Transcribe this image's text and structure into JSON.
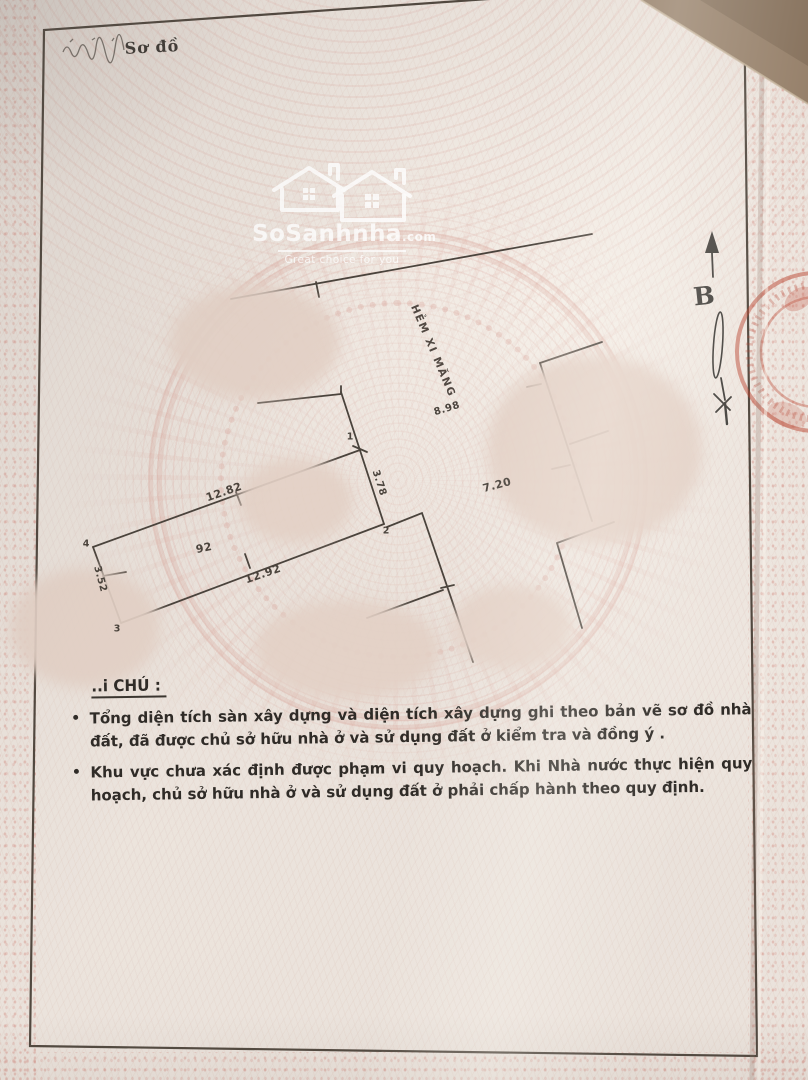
{
  "document": {
    "handwritten_label": "Sơ đồ",
    "note_heading": "..i CHÚ :",
    "notes": [
      {
        "bullet": "•",
        "text": "Tổng diện tích sàn xây dựng và diện tích xây dựng  ghi theo bản vẽ sơ đồ nhà đất, đã được chủ sở hữu nhà ở và sử dụng đất ở kiểm tra và đồng ý ."
      },
      {
        "bullet": "•",
        "text": "Khu vực chưa xác định được phạm vi quy hoạch. Khi Nhà nước thực hiện quy hoạch, chủ sở hữu nhà ở và sử dụng đất ở phải chấp hành theo quy định."
      }
    ]
  },
  "watermark": {
    "brand": "SoSanhnha",
    "suffix": ".com",
    "tagline": "Great choice for you"
  },
  "plan": {
    "street_name": "HẺM XI MĂNG",
    "north_symbol": "B",
    "parcel_number": "92",
    "measurements": {
      "road_frontage": "8.98",
      "north_edge": "12.82",
      "south_edge": "12.92",
      "west_edge": "3.52",
      "front_edge": "3.78",
      "right_edge": "7.20"
    },
    "points": [
      "1",
      "2",
      "3",
      "4"
    ]
  },
  "colors": {
    "paper": "#e9e1da",
    "ink": "#4a433c",
    "pattern_pink": "#d89e94",
    "stamp_red": "#ba4632",
    "note_ink": "#2f2b27"
  }
}
